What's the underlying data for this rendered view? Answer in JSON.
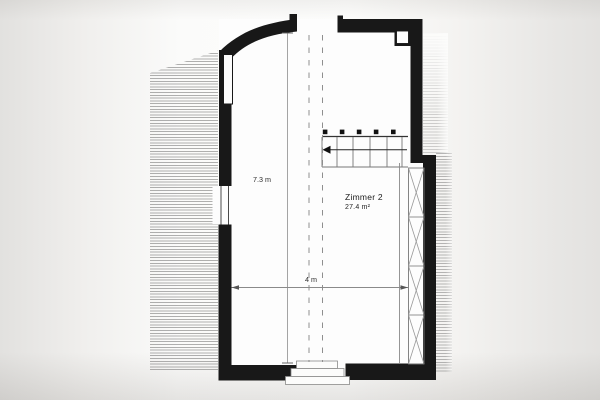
{
  "floorplan": {
    "room_label": "Zimmer 2",
    "room_area": "27.4 m²",
    "dim_vertical": "7.3 m",
    "dim_horizontal": "4 m",
    "colors": {
      "wall": "#181818",
      "paper": "#fdfdfc",
      "background_edge": "#e2e1df",
      "hatch_line": "#6e6e6e",
      "thin_line": "#8a8a8a",
      "text": "#1c1c1c"
    },
    "icons": {
      "stair_direction_arrow": "left-pointing stair run arrow"
    }
  }
}
